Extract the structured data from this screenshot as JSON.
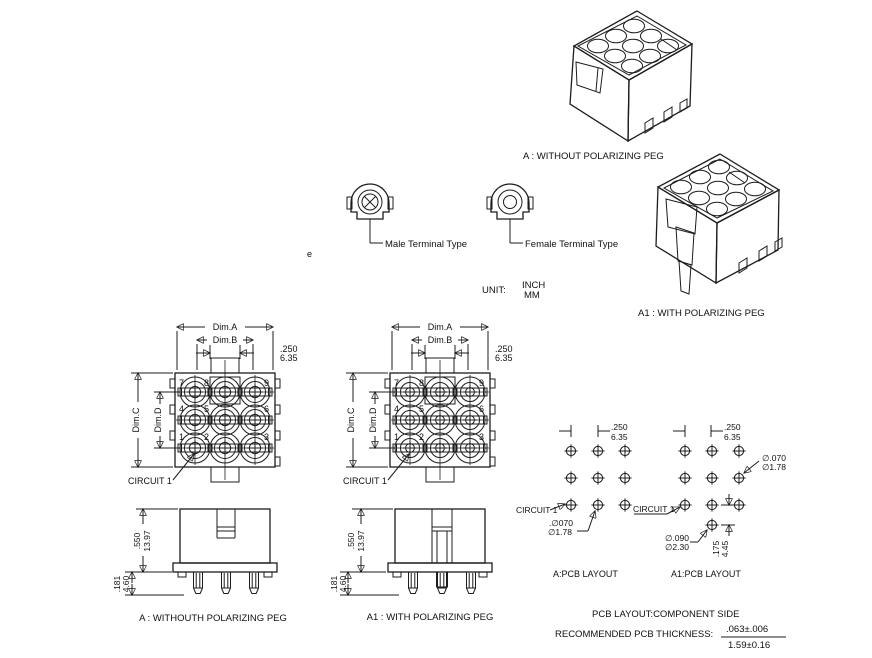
{
  "iso_a": {
    "label": "A : WITHOUT  POLARIZING PEG"
  },
  "iso_a1": {
    "label": "A1 : WITH POLARIZING PEG"
  },
  "terminals": {
    "male": "Male Terminal Type",
    "female": "Female Terminal Type"
  },
  "unit": {
    "label": "UNIT:",
    "inch": "INCH",
    "mm": "MM"
  },
  "stray": "e",
  "front": {
    "dim_a": "Dim.A",
    "dim_b": "Dim.B",
    "dim_c": "Dim.C",
    "dim_d": "Dim.D",
    "pitch_in": ".250",
    "pitch_mm": "6.35",
    "circuit": "CIRCUIT 1",
    "numbers": [
      "7",
      "8",
      "9",
      "4",
      "5",
      "6",
      "1",
      "2",
      "3"
    ]
  },
  "side": {
    "height_in": ".550",
    "height_mm": "13.97",
    "tail_in": ".181",
    "tail_mm": "4.60",
    "a_label": "A : WITHOUTH  POLARIZING PEG",
    "a1_label": "A1 : WITH POLARIZING PEG"
  },
  "pcb_a": {
    "title": "A:PCB LAYOUT",
    "pitch_in": ".250",
    "pitch_mm": "6.35",
    "circuit": "CIRCUIT 1",
    "hole_in": ".∅070",
    "hole_mm": "∅1.78"
  },
  "pcb_a1": {
    "title": "A1:PCB LAYOUT",
    "pitch_in": ".250",
    "pitch_mm": "6.35",
    "circuit": "CIRCUIT 1",
    "hole_in": "∅.070",
    "hole_mm": "∅1.78",
    "peg_in": "∅.090",
    "peg_mm": "∅2.30",
    "offset_in": ".175",
    "offset_mm": "4.45"
  },
  "notes": {
    "pcb_side": "PCB LAYOUT:COMPONENT SIDE",
    "thickness_label": "RECOMMENDED PCB THICKNESS:",
    "thickness_in": ".063±.006",
    "thickness_mm": "1.59±0.16"
  }
}
